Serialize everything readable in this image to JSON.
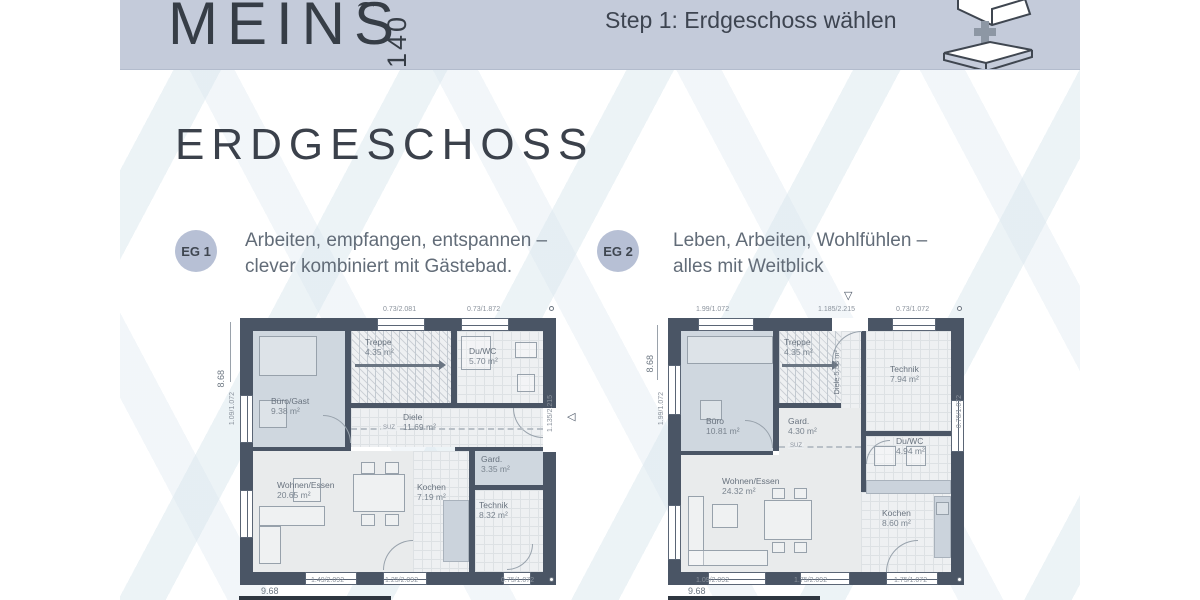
{
  "colors": {
    "header_bg": "#c4cbda",
    "badge_bg": "#b7c0d5",
    "wall": "#4a5565",
    "title_text": "#3b414b",
    "body_text": "#626c78",
    "stripe": "#d6e4ec"
  },
  "header": {
    "logo": "MEINS",
    "logo_number": "140",
    "step_label": "Step 1: Erdgeschoss wählen"
  },
  "page": {
    "title": "ERDGESCHOSS"
  },
  "options": [
    {
      "badge": "EG 1",
      "description_line1": "Arbeiten, empfangen, entspannen –",
      "description_line2": "clever kombiniert mit Gästebad.",
      "rooms": {
        "buero": {
          "name": "Büro/Gast",
          "area": "9.38 m²"
        },
        "treppe": {
          "name": "Treppe",
          "area": "4.35 m²"
        },
        "duwc": {
          "name": "Du/WC",
          "area": "5.70 m²"
        },
        "diele": {
          "name": "Diele",
          "area": "11.69 m²"
        },
        "wohnen": {
          "name": "Wohnen/Essen",
          "area": "20.65 m²"
        },
        "kochen": {
          "name": "Kochen",
          "area": "7.19 m²"
        },
        "gard": {
          "name": "Gard.",
          "area": "3.35 m²"
        },
        "technik": {
          "name": "Technik",
          "area": "8.32 m²"
        }
      },
      "dims": {
        "top1": "0.73/2.081",
        "top2": "0.73/1.872",
        "height_total": "8.68",
        "left1": "1.09/1.072",
        "right1": "1.135/2.215",
        "bottom1": "1.49/2.092",
        "bottom2": "1.25/2.092",
        "bottom3": "0.75/1.072",
        "width_total": "9.68",
        "beam": "SUZ"
      }
    },
    {
      "badge": "EG 2",
      "description_line1": "Leben, Arbeiten, Wohlfühlen –",
      "description_line2": "alles mit Weitblick",
      "rooms": {
        "buero": {
          "name": "Büro",
          "area": "10.81 m²"
        },
        "treppe": {
          "name": "Treppe",
          "area": "4.35 m²"
        },
        "diele": {
          "name": "Diele",
          "area": "5.53 m²"
        },
        "technik": {
          "name": "Technik",
          "area": "7.94 m²"
        },
        "gard": {
          "name": "Gard.",
          "area": "4.30 m²"
        },
        "duwc": {
          "name": "Du/WC",
          "area": "4.94 m²"
        },
        "wohnen": {
          "name": "Wohnen/Essen",
          "area": "24.32 m²"
        },
        "kochen": {
          "name": "Kochen",
          "area": "8.60 m²"
        }
      },
      "dims": {
        "top1": "1.99/1.072",
        "top2": "1.185/2.215",
        "top3": "0.73/1.072",
        "height_total": "8.68",
        "left1": "1.99/1.072",
        "right1": "0.76/1.072",
        "bottom1": "1.09/2.092",
        "bottom2": "1.75/2.092",
        "bottom3": "1.75/1.072",
        "width_total": "9.68",
        "beam": "SUZ"
      }
    }
  ]
}
